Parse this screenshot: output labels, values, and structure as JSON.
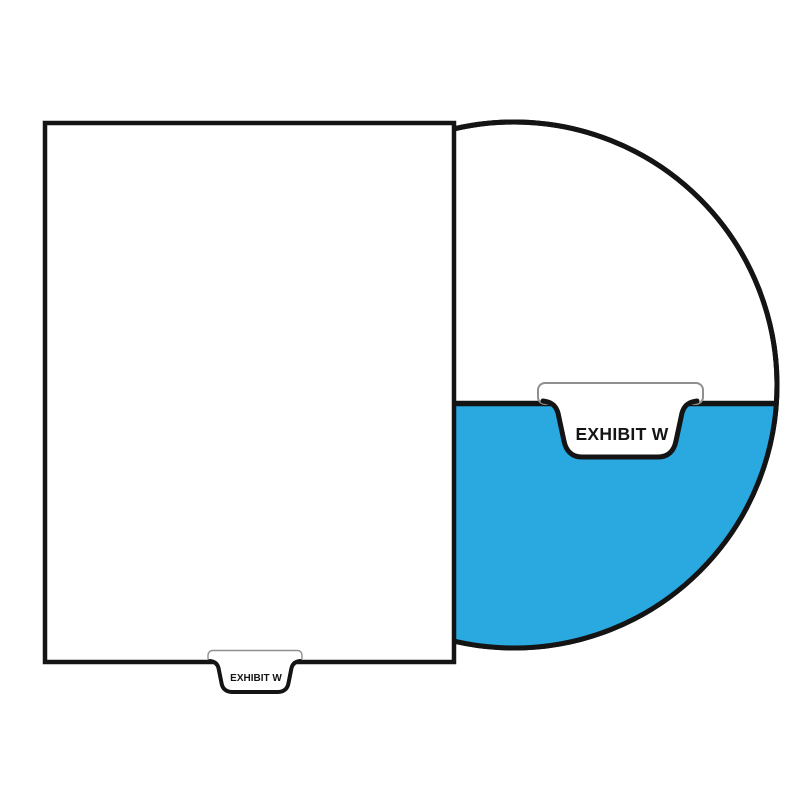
{
  "illustration": {
    "type": "legal-exhibit-divider-product-diagram",
    "sheet_tab": {
      "label": "EXHIBIT W"
    },
    "magnified_tab": {
      "label": "EXHIBIT W"
    },
    "colors": {
      "background": "#ffffff",
      "highlight_blue": "#2aa8e0",
      "outline_black": "#141414",
      "tab_top_border_grey": "#8f8f8f",
      "sheet_fill": "#ffffff"
    }
  }
}
